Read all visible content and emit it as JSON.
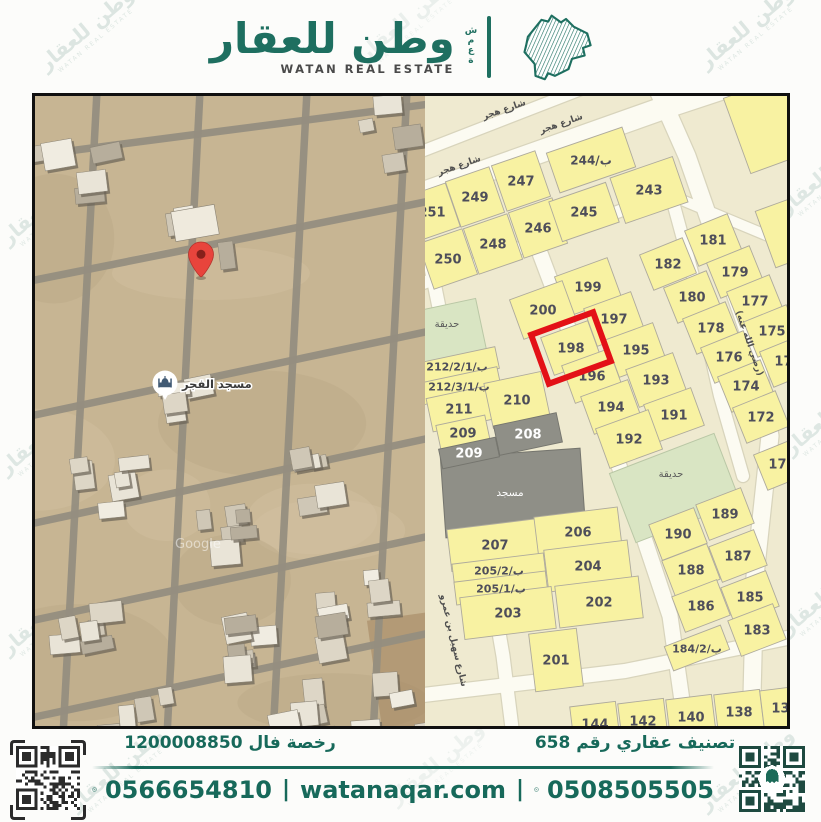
{
  "brand": {
    "logo_arabic": "وطن للعقار",
    "logo_english": "WATAN REAL ESTATE",
    "logo_vertical_letters": "شمعة",
    "accent": "#1e6f60",
    "watermark_text": "وطن للعقار",
    "watermark_sub": "WATAN REAL ESTATE"
  },
  "left_map": {
    "type": "satellite",
    "pin": {
      "x": 166,
      "y": 180
    },
    "poi": {
      "label": "مسجد الفجر",
      "x": 130,
      "y": 287
    },
    "attribution": "Google"
  },
  "right_map": {
    "type": "parcel-plan",
    "highlighted_parcel": "198",
    "colors": {
      "block_bg": "#efead0",
      "street": "#fcfbf2",
      "street_casing": "#d8d4bc",
      "parcel": "#f8f2a2",
      "parcel_stroke": "#aeaa9c",
      "gray_parcel": "#8f8f87",
      "garden": "#d9e5c3",
      "label": "#4e4e5a",
      "highlight": "#e31117"
    },
    "streets": [
      {
        "pts": [
          [
            -10,
            100
          ],
          [
            250,
            8
          ],
          [
            380,
            -35
          ]
        ],
        "w": 22
      },
      {
        "pts": [
          [
            -10,
            58
          ],
          [
            160,
            -8
          ]
        ],
        "w": 11
      },
      {
        "pts": [
          [
            232,
            -8
          ],
          [
            262,
            60
          ],
          [
            330,
            255
          ],
          [
            345,
            340
          ],
          [
            330,
            480
          ],
          [
            326,
            640
          ]
        ],
        "w": 17
      },
      {
        "pts": [
          [
            -10,
            190
          ],
          [
            150,
            132
          ],
          [
            245,
            96
          ]
        ],
        "w": 12
      },
      {
        "pts": [
          [
            240,
            97
          ],
          [
            372,
            152
          ]
        ],
        "w": 10
      },
      {
        "pts": [
          [
            113,
            152
          ],
          [
            150,
            250
          ],
          [
            205,
            400
          ],
          [
            245,
            520
          ],
          [
            262,
            640
          ]
        ],
        "w": 15
      },
      {
        "pts": [
          [
            2,
            152
          ],
          [
            40,
            340
          ],
          [
            78,
            560
          ],
          [
            88,
            640
          ]
        ],
        "w": 13
      },
      {
        "pts": [
          [
            245,
            95
          ],
          [
            268,
            180
          ],
          [
            295,
            300
          ],
          [
            318,
            380
          ]
        ],
        "w": 12
      },
      {
        "pts": [
          [
            -10,
            600
          ],
          [
            200,
            575
          ],
          [
            372,
            540
          ]
        ],
        "w": 14
      }
    ],
    "street_labels": [
      {
        "text": "شارع هجر",
        "x": 80,
        "y": 16,
        "rot": -19
      },
      {
        "text": "شارع هجر",
        "x": 137,
        "y": 30,
        "rot": -19
      },
      {
        "text": "شارع هجر",
        "x": 35,
        "y": 72,
        "rot": -19
      },
      {
        "text": "(رضي الله عنه)",
        "x": 322,
        "y": 248,
        "rot": 71
      },
      {
        "text": "شارع سهيل بن عمرو",
        "x": 26,
        "y": 545,
        "rot": 77
      }
    ],
    "blocks": [
      {
        "name": "top",
        "rot": -19,
        "parcels": [
          {
            "l": "251",
            "x": 7,
            "y": 116,
            "w": 44,
            "h": 46
          },
          {
            "l": "249",
            "x": 50,
            "y": 101,
            "w": 46,
            "h": 48
          },
          {
            "l": "247",
            "x": 96,
            "y": 85,
            "w": 46,
            "h": 48
          },
          {
            "l": "244/ب",
            "x": 166,
            "y": 64,
            "w": 80,
            "h": 42,
            "fs": 12
          },
          {
            "l": "250",
            "x": 23,
            "y": 163,
            "w": 46,
            "h": 48
          },
          {
            "l": "248",
            "x": 68,
            "y": 148,
            "w": 46,
            "h": 48
          },
          {
            "l": "246",
            "x": 113,
            "y": 132,
            "w": 46,
            "h": 48
          },
          {
            "l": "245",
            "x": 159,
            "y": 116,
            "w": 60,
            "h": 42
          },
          {
            "l": "243",
            "x": 224,
            "y": 94,
            "w": 66,
            "h": 48
          }
        ]
      },
      {
        "name": "right-column",
        "rot": -22,
        "parcels": [
          {
            "l": "182",
            "x": 243,
            "y": 168,
            "w": 46,
            "h": 38
          },
          {
            "l": "181",
            "x": 288,
            "y": 144,
            "w": 46,
            "h": 38
          },
          {
            "l": "180",
            "x": 267,
            "y": 201,
            "w": 46,
            "h": 38
          },
          {
            "l": "179",
            "x": 310,
            "y": 176,
            "w": 46,
            "h": 38
          },
          {
            "l": "178",
            "x": 286,
            "y": 232,
            "w": 46,
            "h": 38
          },
          {
            "l": "177",
            "x": 330,
            "y": 205,
            "w": 46,
            "h": 38
          },
          {
            "l": "176",
            "x": 304,
            "y": 261,
            "w": 46,
            "h": 38
          },
          {
            "l": "175",
            "x": 347,
            "y": 235,
            "w": 46,
            "h": 38
          },
          {
            "l": "174",
            "x": 321,
            "y": 290,
            "w": 46,
            "h": 38
          },
          {
            "l": "173",
            "x": 363,
            "y": 265,
            "w": 46,
            "h": 38
          },
          {
            "l": "172",
            "x": 336,
            "y": 321,
            "w": 46,
            "h": 38
          },
          {
            "l": "170",
            "x": 357,
            "y": 368,
            "w": 46,
            "h": 38
          }
        ]
      },
      {
        "name": "middle",
        "rot": -20,
        "parcels": [
          {
            "l": "199",
            "x": 163,
            "y": 191,
            "w": 56,
            "h": 42
          },
          {
            "l": "200",
            "x": 118,
            "y": 214,
            "w": 56,
            "h": 42
          },
          {
            "l": "197",
            "x": 189,
            "y": 223,
            "w": 50,
            "h": 40
          },
          {
            "l": "198",
            "x": 146,
            "y": 252,
            "w": 50,
            "h": 40,
            "hl": true
          },
          {
            "l": "195",
            "x": 211,
            "y": 254,
            "w": 50,
            "h": 40
          },
          {
            "l": "196",
            "x": 167,
            "y": 280,
            "w": 50,
            "h": 40
          },
          {
            "l": "193",
            "x": 231,
            "y": 284,
            "w": 50,
            "h": 40
          },
          {
            "l": "194",
            "x": 186,
            "y": 311,
            "w": 50,
            "h": 40
          },
          {
            "l": "191",
            "x": 249,
            "y": 319,
            "w": 50,
            "h": 40
          },
          {
            "l": "192",
            "x": 204,
            "y": 343,
            "w": 56,
            "h": 42
          }
        ]
      },
      {
        "name": "left-middle",
        "rot": -12,
        "parcels": [
          {
            "l": "212/2/1/ب",
            "x": 32,
            "y": 270,
            "w": 82,
            "h": 22,
            "fs": 11
          },
          {
            "l": "212/3/1/ب",
            "x": 34,
            "y": 290,
            "w": 82,
            "h": 22,
            "fs": 11
          },
          {
            "l": "211",
            "x": 34,
            "y": 313,
            "w": 60,
            "h": 34
          },
          {
            "l": "210",
            "x": 92,
            "y": 304,
            "w": 58,
            "h": 46
          },
          {
            "l": "209",
            "x": 38,
            "y": 337,
            "w": 50,
            "h": 26
          },
          {
            "l": "209",
            "x": 44,
            "y": 357,
            "w": 58,
            "h": 20,
            "gray": true
          },
          {
            "l": "208",
            "x": 103,
            "y": 338,
            "w": 64,
            "h": 30,
            "gray": true
          }
        ]
      },
      {
        "name": "bottom-left",
        "rot": -7,
        "parcels": [
          {
            "l": "207",
            "x": 70,
            "y": 449,
            "w": 92,
            "h": 42
          },
          {
            "l": "206",
            "x": 153,
            "y": 436,
            "w": 84,
            "h": 40
          },
          {
            "l": "205/2/ب",
            "x": 74,
            "y": 474,
            "w": 92,
            "h": 23,
            "fs": 11
          },
          {
            "l": "205/1/ب",
            "x": 76,
            "y": 492,
            "w": 92,
            "h": 23,
            "fs": 11
          },
          {
            "l": "204",
            "x": 163,
            "y": 470,
            "w": 84,
            "h": 42
          },
          {
            "l": "203",
            "x": 83,
            "y": 517,
            "w": 92,
            "h": 42
          },
          {
            "l": "202",
            "x": 174,
            "y": 506,
            "w": 84,
            "h": 42
          },
          {
            "l": "201",
            "x": 131,
            "y": 564,
            "w": 48,
            "h": 58
          }
        ]
      },
      {
        "name": "bottom-right",
        "rot": -21,
        "parcels": [
          {
            "l": "189",
            "x": 300,
            "y": 418,
            "w": 48,
            "h": 38
          },
          {
            "l": "190",
            "x": 253,
            "y": 438,
            "w": 48,
            "h": 38
          },
          {
            "l": "187",
            "x": 313,
            "y": 460,
            "w": 48,
            "h": 38
          },
          {
            "l": "188",
            "x": 266,
            "y": 474,
            "w": 48,
            "h": 38
          },
          {
            "l": "185",
            "x": 325,
            "y": 501,
            "w": 48,
            "h": 38
          },
          {
            "l": "186",
            "x": 276,
            "y": 510,
            "w": 48,
            "h": 38
          },
          {
            "l": "183",
            "x": 332,
            "y": 534,
            "w": 48,
            "h": 38
          },
          {
            "l": "184/2/ب",
            "x": 272,
            "y": 552,
            "w": 60,
            "h": 26,
            "fs": 11
          }
        ]
      },
      {
        "name": "bottom-row",
        "rot": -7,
        "parcels": [
          {
            "l": "144",
            "x": 170,
            "y": 628,
            "w": 46,
            "h": 40
          },
          {
            "l": "142",
            "x": 218,
            "y": 625,
            "w": 46,
            "h": 40
          },
          {
            "l": "140",
            "x": 266,
            "y": 621,
            "w": 46,
            "h": 40
          },
          {
            "l": "138",
            "x": 314,
            "y": 616,
            "w": 46,
            "h": 40
          },
          {
            "l": "136",
            "x": 360,
            "y": 612,
            "w": 46,
            "h": 40
          }
        ]
      },
      {
        "name": "top-right-corner",
        "rot": -20,
        "parcels": [
          {
            "l": "",
            "x": 345,
            "y": 28,
            "w": 70,
            "h": 80
          },
          {
            "l": "",
            "x": 364,
            "y": 135,
            "w": 50,
            "h": 60
          }
        ]
      }
    ],
    "gardens": [
      {
        "label": "حديقة",
        "x": 25,
        "y": 236,
        "w": 64,
        "h": 55,
        "rot": -12,
        "lx": 22,
        "ly": 231
      },
      {
        "label": "حديقة",
        "x": 250,
        "y": 392,
        "w": 112,
        "h": 74,
        "rot": -21,
        "lx": 246,
        "ly": 381
      }
    ],
    "mosque": {
      "label": "مسجد",
      "x": 88,
      "y": 397,
      "w": 140,
      "h": 80,
      "rot": -4
    }
  },
  "footer": {
    "license_label": "رخصة فال 1200008850",
    "classification_label": "تصنيف عقاري رقم 658",
    "phone_primary": "0566654810",
    "website": "watanaqar.com",
    "phone_secondary": "0508505505",
    "separator": "|"
  }
}
